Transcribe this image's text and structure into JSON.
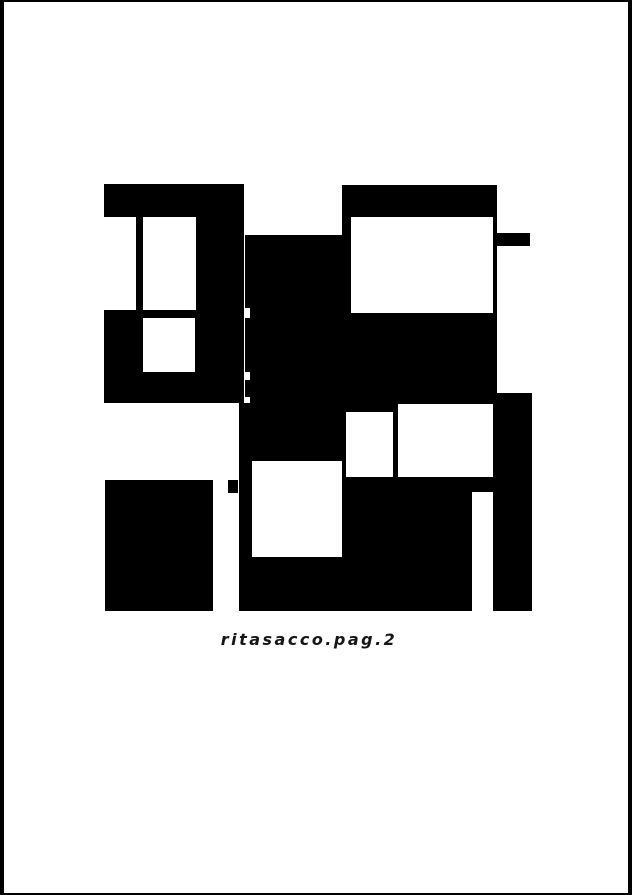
{
  "artwork": {
    "caption": "ritasacco.pag.2",
    "palette": {
      "ink": "#000000",
      "paper": "#ffffff",
      "caption_color": "#161616",
      "frame_color": "#000000"
    },
    "frame": {
      "border_top": 2,
      "border_right": 4,
      "border_bottom": 2,
      "border_left": 4
    },
    "canvas": {
      "width": 632,
      "height": 895
    },
    "shapes": [
      {
        "name": "top-left-bar",
        "color": "ink",
        "x": 104,
        "y": 184,
        "w": 140,
        "h": 33
      },
      {
        "name": "left-inner-line",
        "color": "ink",
        "x": 136,
        "y": 217,
        "w": 7,
        "h": 93
      },
      {
        "name": "top-left-right-column",
        "color": "ink",
        "x": 196,
        "y": 217,
        "w": 48,
        "h": 93
      },
      {
        "name": "mid-left-block",
        "color": "ink",
        "x": 104,
        "y": 310,
        "w": 140,
        "h": 93
      },
      {
        "name": "dash-segment-1",
        "color": "ink",
        "x": 245,
        "y": 235,
        "w": 7,
        "h": 73
      },
      {
        "name": "dash-segment-2",
        "color": "ink",
        "x": 245,
        "y": 318,
        "w": 7,
        "h": 54
      },
      {
        "name": "dash-segment-3",
        "color": "ink",
        "x": 245,
        "y": 380,
        "w": 7,
        "h": 17
      },
      {
        "name": "central-block",
        "color": "ink",
        "x": 250,
        "y": 235,
        "w": 93,
        "h": 168
      },
      {
        "name": "top-right-block",
        "color": "ink",
        "x": 342,
        "y": 185,
        "w": 155,
        "h": 208
      },
      {
        "name": "right-side-tab",
        "color": "ink",
        "x": 497,
        "y": 233,
        "w": 33,
        "h": 13
      },
      {
        "name": "connector-band",
        "color": "ink",
        "x": 250,
        "y": 393,
        "w": 243,
        "h": 12
      },
      {
        "name": "bottom-center-mass",
        "color": "ink",
        "x": 239,
        "y": 403,
        "w": 233,
        "h": 208
      },
      {
        "name": "right-bridge",
        "color": "ink",
        "x": 472,
        "y": 477,
        "w": 21,
        "h": 15
      },
      {
        "name": "right-column",
        "color": "ink",
        "x": 493,
        "y": 393,
        "w": 39,
        "h": 218
      },
      {
        "name": "bottom-left-block",
        "color": "ink",
        "x": 105,
        "y": 480,
        "w": 108,
        "h": 131
      },
      {
        "name": "left-notch-tab",
        "color": "ink",
        "x": 228,
        "y": 480,
        "w": 10,
        "h": 13
      },
      {
        "name": "under-bar-opening",
        "color": "paper",
        "x": 104,
        "y": 217,
        "w": 32,
        "h": 93
      },
      {
        "name": "top-left-window",
        "color": "paper",
        "x": 143,
        "y": 217,
        "w": 53,
        "h": 93
      },
      {
        "name": "mid-left-window",
        "color": "paper",
        "x": 143,
        "y": 318,
        "w": 52,
        "h": 54
      },
      {
        "name": "top-right-window",
        "color": "paper",
        "x": 351,
        "y": 217,
        "w": 142,
        "h": 96
      },
      {
        "name": "small-center-window",
        "color": "paper",
        "x": 346,
        "y": 412,
        "w": 47,
        "h": 65
      },
      {
        "name": "center-right-window",
        "color": "paper",
        "x": 398,
        "y": 404,
        "w": 95,
        "h": 73
      },
      {
        "name": "central-square-window",
        "color": "paper",
        "x": 252,
        "y": 461,
        "w": 90,
        "h": 96
      }
    ]
  }
}
